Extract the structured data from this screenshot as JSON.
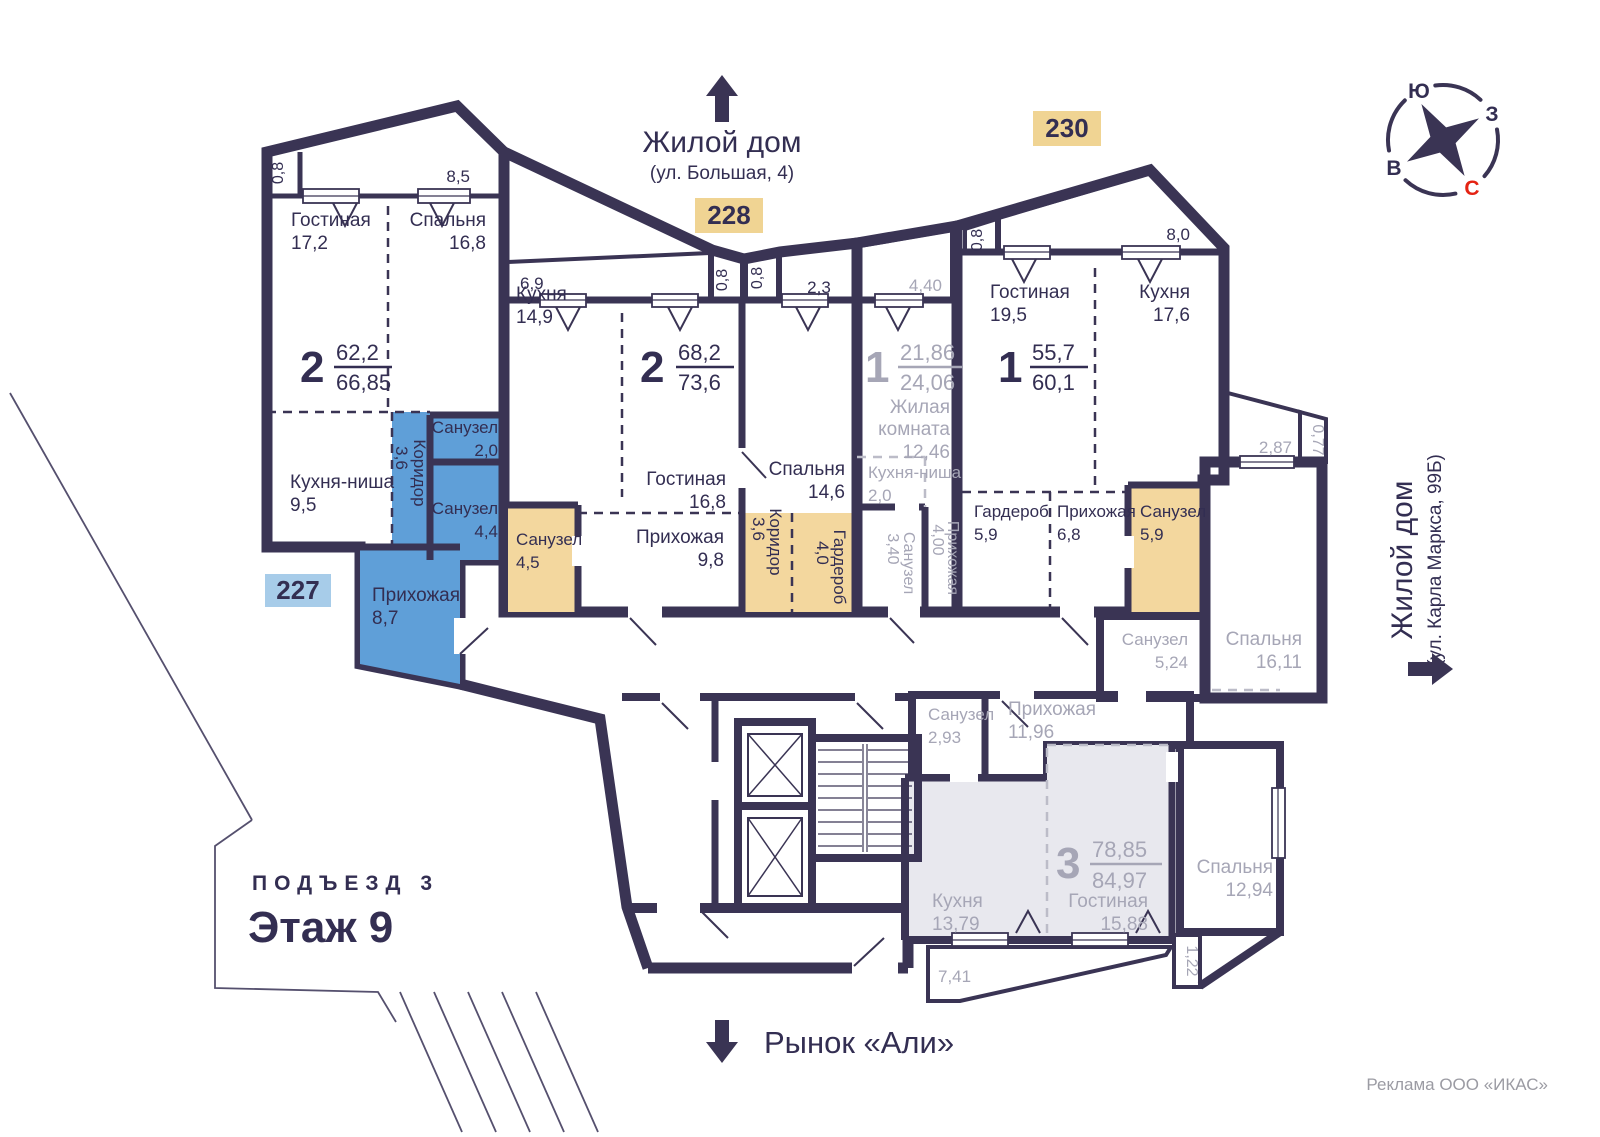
{
  "page": {
    "podezd_label": "ПОДЪЕЗД 3",
    "floor_label": "Этаж 9",
    "credit": "Реклама ООО «ИКАС»",
    "landmark_top": {
      "title": "Жилой дом",
      "subtitle": "(ул. Большая, 4)"
    },
    "landmark_right": {
      "title": "Жилой дом",
      "subtitle": "(ул. Карла Маркса, 99Б)"
    },
    "landmark_bottom": {
      "title": "Рынок «Али»"
    },
    "compass": {
      "north": "С",
      "south": "Ю",
      "east": "В",
      "west": "З"
    }
  },
  "apartments": {
    "a227": {
      "badge": "227",
      "rooms": "2",
      "area_living": "62,2",
      "area_total": "66,85",
      "living": {
        "name": "Гостиная",
        "area": "17,2"
      },
      "bedroom": {
        "name": "Спальня",
        "area": "16,8"
      },
      "kitchen": {
        "name": "Кухня-ниша",
        "area": "9,5"
      },
      "corridor": {
        "name": "Коридор",
        "area": "3,6"
      },
      "wc_small": {
        "name": "Санузел",
        "area": "2,0"
      },
      "wc": {
        "name": "Санузел",
        "area": "4,4"
      },
      "hall": {
        "name": "Прихожая",
        "area": "8,7"
      },
      "balcony_left": "0,8",
      "balcony_top": "8,5"
    },
    "a228": {
      "badge": "228",
      "rooms": "2",
      "area_living": "68,2",
      "area_total": "73,6",
      "kitchen": {
        "name": "Кухня",
        "area": "14,9"
      },
      "living": {
        "name": "Гостиная",
        "area": "16,8"
      },
      "bedroom": {
        "name": "Спальня",
        "area": "14,6"
      },
      "wc": {
        "name": "Санузел",
        "area": "4,5"
      },
      "hall": {
        "name": "Прихожая",
        "area": "9,8"
      },
      "corridor": {
        "name": "Коридор",
        "area": "3,6"
      },
      "wardrobe": {
        "name": "Гардероб",
        "area": "4,0"
      },
      "balcony_main": "6,9",
      "balcony_mid_left": "0,8",
      "balcony_mid_right": "0,8",
      "balcony_right": "2,3"
    },
    "studio": {
      "rooms": "1",
      "area_living": "21,86",
      "area_total": "24,06",
      "living": {
        "name1": "Жилая",
        "name2": "комната",
        "area": "12,46"
      },
      "kitchen": {
        "name": "Кухня-ниша",
        "area": "2,0"
      },
      "wc": {
        "name": "Санузел",
        "area": "3,40"
      },
      "hall": {
        "name": "Прихожая",
        "area": "4,00"
      },
      "balcony": "4,40"
    },
    "a230": {
      "badge": "230",
      "rooms": "1",
      "area_living": "55,7",
      "area_total": "60,1",
      "living": {
        "name": "Гостиная",
        "area": "19,5"
      },
      "kitchen": {
        "name": "Кухня",
        "area": "17,6"
      },
      "wardrobe": {
        "name": "Гардероб",
        "area": "5,9"
      },
      "hall": {
        "name": "Прихожая",
        "area": "6,8"
      },
      "wc": {
        "name": "Санузел",
        "area": "5,9"
      },
      "balcony_left": "0,8",
      "balcony_top": "8,0"
    },
    "a3room": {
      "rooms": "3",
      "area_living": "78,85",
      "area_total": "84,97",
      "wc_top": {
        "name": "Санузел",
        "area": "5,24"
      },
      "bedroom1": {
        "name": "Спальня",
        "area": "16,11"
      },
      "wc": {
        "name": "Санузел",
        "area": "2,93"
      },
      "hall": {
        "name": "Прихожая",
        "area": "11,96"
      },
      "kitchen": {
        "name": "Кухня",
        "area": "13,79"
      },
      "living": {
        "name": "Гостиная",
        "area": "15,88"
      },
      "bedroom2": {
        "name": "Спальня",
        "area": "12,94"
      },
      "balcony_top": "2,87",
      "balcony_top_side": "0,77",
      "balcony_bottom": "7,41",
      "balcony_side": "1,22"
    }
  }
}
